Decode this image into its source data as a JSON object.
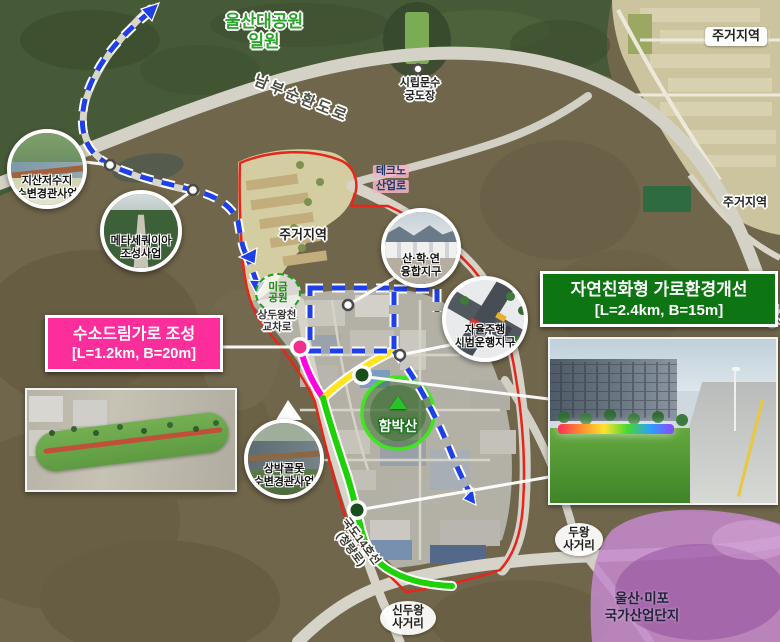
{
  "labels": {
    "park": [
      "울산대공원",
      "일원"
    ],
    "archery": [
      "시립문수",
      "궁도장"
    ],
    "ring_road": "남부순환도로",
    "ring_road_right": "남부순환도로",
    "residential_ne": "주거지역",
    "residential_center": "주거지역",
    "residential_east": "주거지역",
    "techno_road": [
      "테크노",
      "산업로"
    ],
    "migeum_park": [
      "미금",
      "공원"
    ],
    "sangduwang_crossing": [
      "상두왕천",
      "교차로"
    ],
    "hambaksan": "함박산",
    "national_route14": [
      "국도14호선",
      "(청량로)"
    ],
    "sinduwang": [
      "신두왕",
      "사거리"
    ],
    "duwang": [
      "두왕",
      "사거리"
    ],
    "industrial_complex": [
      "울산·미포",
      "국가산업단지"
    ]
  },
  "projects": {
    "jisan": [
      "지산저수지",
      "수변경관사업"
    ],
    "metasequoia": [
      "메타세쿼이아",
      "조성사업"
    ],
    "sanhakyeon": [
      "산·학·연",
      "융합지구"
    ],
    "autonomous": [
      "자율주행",
      "시범운행지구"
    ],
    "sangbakgol": [
      "상박골못",
      "수변경관사업"
    ]
  },
  "callouts": {
    "hydrogen": {
      "title": "수소드림가로 조성",
      "spec": "[L=1.2km, B=20m]"
    },
    "eco": {
      "title": "자연친화형 가로환경개선",
      "spec": "[L=2.4km, B=15m]"
    }
  },
  "colors": {
    "route_green": "#1fd106",
    "route_yellow": "#ffe41c",
    "route_magenta": "#ff04e2",
    "route_blue_dashed": "#1f3fe8",
    "district_boundary_red": "#e8231c",
    "hydrogen_callout_pink": "#fc2e9c",
    "eco_callout_green": "#0d7512",
    "industrial_zone_purple": "#a465b5",
    "park_label_green": "#2ba32b"
  }
}
